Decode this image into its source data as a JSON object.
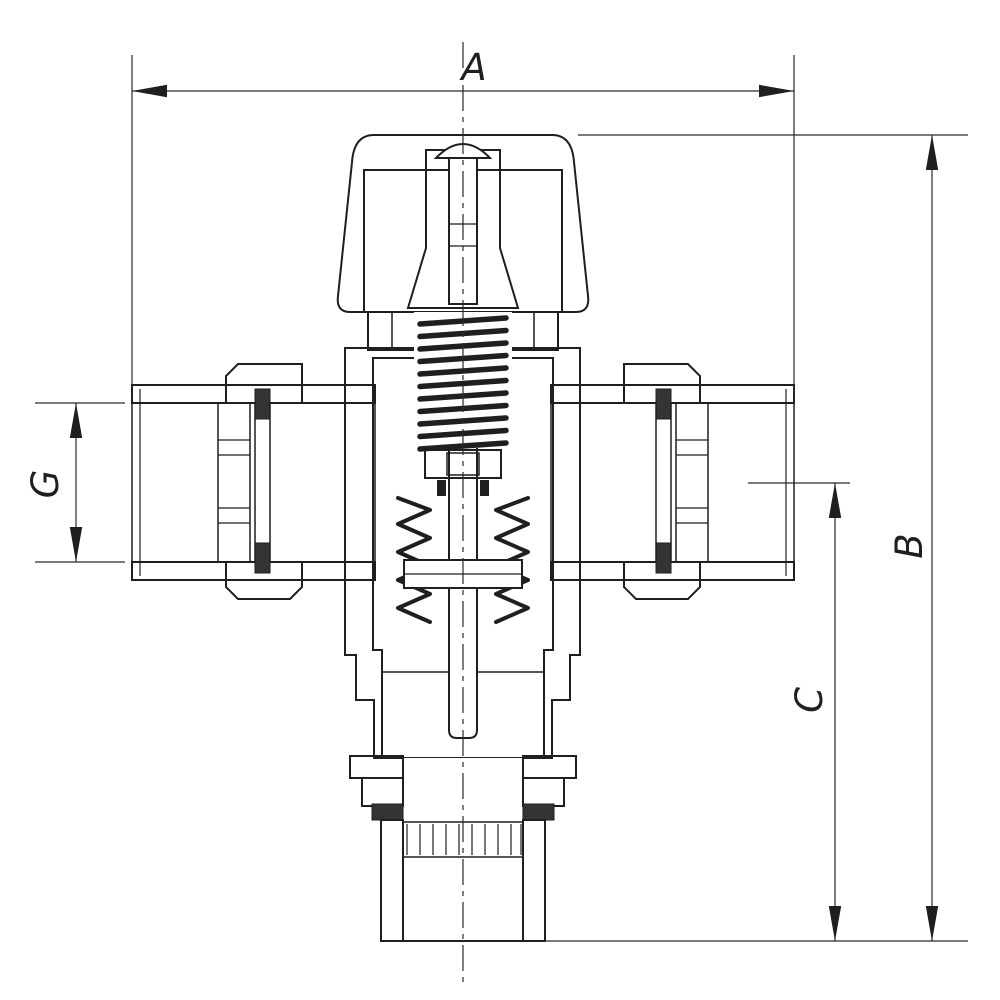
{
  "drawing": {
    "background": "#ffffff",
    "line_color": "#1f1f1f",
    "dim_labels": {
      "overall_width": "A",
      "overall_height": "B",
      "outlet_offset": "C",
      "port_bore": "G"
    }
  }
}
